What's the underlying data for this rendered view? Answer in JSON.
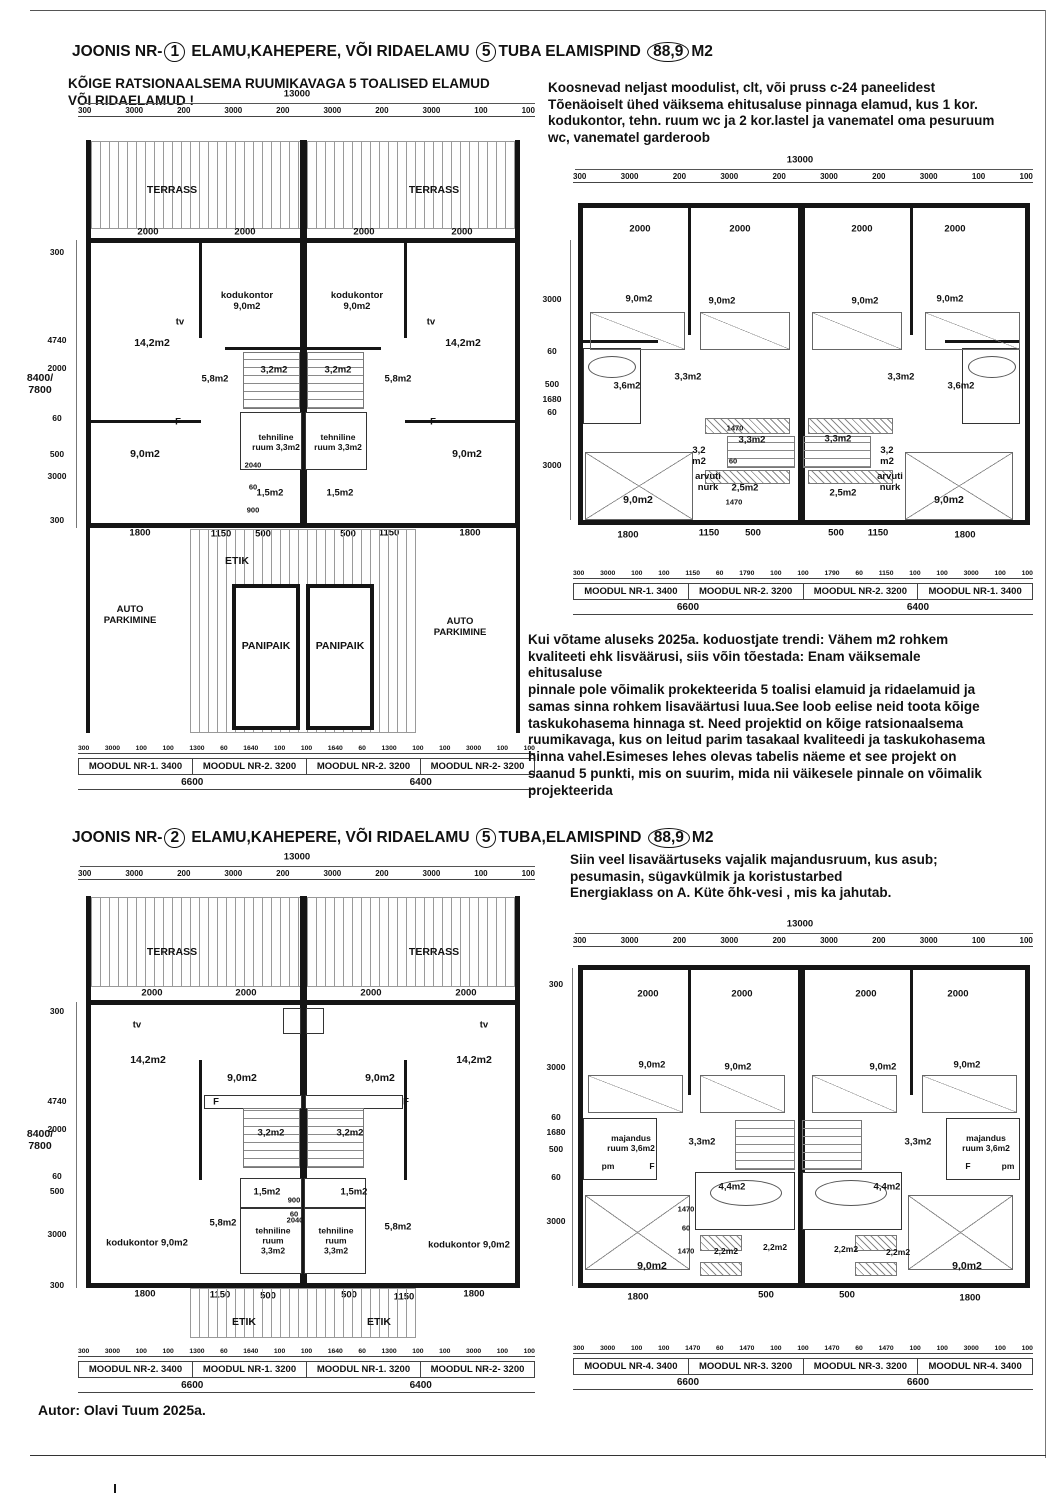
{
  "joonis1": {
    "title": {
      "pre": "JOONIS NR-",
      "n": "1",
      "mid": "ELAMU,KAHEPERE, VÕI RIDAELAMU",
      "rooms": "5",
      "mid2": "TUBA ELAMISPIND",
      "area": "88,9",
      "unit": "M2"
    },
    "subtitle": "KÕIGE RATSIONAALSEMA RUUMIKAVAGA  5 TOALISED ELAMUD\nVÕI RIDAELAMUD !",
    "desc": "Koosnevad neljast moodulist, clt, või pruss c-24 paneelidest\nTõenäoiselt ühed väiksema ehitusaluse pinnaga elamud, kus  1 kor.\nkodukontor, tehn. ruum  wc ja 2 kor.lastel ja vanematel oma pesuruum\nwc, vanematel garderoob"
  },
  "joonis2": {
    "title": {
      "pre": "JOONIS NR-",
      "n": "2",
      "mid": "ELAMU,KAHEPERE, VÕI RIDAELAMU",
      "rooms": "5",
      "mid2": "TUBA,ELAMISPIND",
      "area": "88,9",
      "unit": "M2"
    },
    "desc": "Siin veel lisaväärtuseks vajalik  majandusruum, kus asub;\npesumasin, sügavkülmik ja koristustarbed\nEnergiaklass on A. Küte õhk-vesi , mis ka jahutab."
  },
  "mid_text": "Kui võtame aluseks  2025a. koduostjate trendi: Vähem m2 rohkem\nkvaliteeti ehk lisväärusi, siis võin tõestada: Enam väiksemale\nehitusaluse\npinnale pole võimalik prokekteerida 5 toalisi elamuid ja ridaelamuid ja\nsamas sinna rohkem lisaväärtusi luua.See loob eelise neid toota kõige\ntaskukohasema hinnaga st. Need projektid on kõige ratsionaalsema\nruumikavaga, kus on leitud parim tasakaal kvaliteedi ja taskukohasema\nhinna vahel.Esimeses lehes olevas tabelis näeme et see projekt on\nsaanud  5 punkti, mis on suurim, mida nii väikesele pinnale on võimalik\nprojekteerida",
  "footer": "Autor:  Olavi  Tuum        2025a.",
  "plans": {
    "p1": {
      "total_top": "13000",
      "top_chain": [
        "300",
        "3000",
        "200",
        "3000",
        "200",
        "3000",
        "200",
        "3000",
        "100",
        "100"
      ],
      "win": "2000",
      "left_chain": [
        "300",
        "4740",
        "2000",
        "60",
        "500",
        "3000",
        "300"
      ],
      "left_total": "8400/\n7800",
      "rooms": {
        "terrass": "TERRASS",
        "kodukontor": "kodukontor\n9,0m2",
        "tv": "tv",
        "living": "14,2m2",
        "stair": "3,2m2",
        "r58": "5,8m2",
        "f": "F",
        "tehniline": "tehniline\nruum 3,3m2",
        "d2040": "2040",
        "kitchen": "9,0m2",
        "d60": "60",
        "wc": "1,5m2",
        "d900": "900",
        "etik": "ETIK",
        "auto": "AUTO\nPARKIMINE",
        "panipaik": "PANIPAIK"
      },
      "mid_dims": [
        "1800",
        "1150",
        "500",
        "500",
        "1150",
        "1800"
      ],
      "bot_chain": [
        "300",
        "3000",
        "100",
        "100",
        "1300",
        "60",
        "1640",
        "100",
        "100",
        "1640",
        "60",
        "1300",
        "100",
        "100",
        "3000",
        "100",
        "100"
      ],
      "modules": [
        "MOODUL NR-1. 3400",
        "MOODUL NR-2. 3200",
        "MOODUL NR-2. 3200",
        "MOODUL NR-2- 3200"
      ],
      "totals": [
        "6600",
        "6400"
      ]
    },
    "p2": {
      "total_top": "13000",
      "top_chain": [
        "300",
        "3000",
        "200",
        "3000",
        "200",
        "3000",
        "200",
        "3000",
        "100",
        "100"
      ],
      "win": "2000",
      "left_chain": [
        "3000",
        "60",
        "500",
        "1680",
        "60",
        "3000"
      ],
      "rooms": {
        "bed": "9,0m2",
        "bath36": "3,6m2",
        "hall33": "3,3m2",
        "mid33": "3,3m2",
        "d1470": "1470",
        "d60": "60",
        "r32": "3,2\nm2",
        "arvuti": "arvuti\nnurk",
        "r25": "2,5m2",
        "bed2": "9,0m2"
      },
      "mid_dims": [
        "1800",
        "1150",
        "500",
        "500",
        "1150",
        "1800"
      ],
      "bot_chain": [
        "300",
        "3000",
        "100",
        "100",
        "1150",
        "60",
        "1790",
        "100",
        "100",
        "1790",
        "60",
        "1150",
        "100",
        "100",
        "3000",
        "100",
        "100"
      ],
      "modules": [
        "MOODUL NR-1. 3400",
        "MOODUL NR-2. 3200",
        "MOODUL NR-2. 3200",
        "MOODUL NR-1. 3400"
      ],
      "totals": [
        "6600",
        "6400"
      ]
    },
    "p3": {
      "total_top": "13000",
      "top_chain": [
        "300",
        "3000",
        "200",
        "3000",
        "200",
        "3000",
        "200",
        "3000",
        "100",
        "100"
      ],
      "win": "2000",
      "left_chain": [
        "300",
        "4740",
        "2000",
        "60",
        "500",
        "3000",
        "300"
      ],
      "left_total": "8400/\n7800",
      "rooms": {
        "terrass": "TERRASS",
        "tv": "tv",
        "living": "14,2m2",
        "dining": "9,0m2",
        "f": "F",
        "stair": "3,2m2",
        "wc": "1,5m2",
        "d900": "900",
        "d60": "60",
        "r58": "5,8m2",
        "tehniline": "tehniline\nruum\n3,3m2",
        "d2040": "2040",
        "kodukontor": "kodukontor 9,0m2",
        "etik": "ETIK"
      },
      "mid_dims": [
        "1800",
        "1150",
        "500",
        "500",
        "1150",
        "1800"
      ],
      "bot_chain": [
        "300",
        "3000",
        "100",
        "100",
        "1300",
        "60",
        "1640",
        "100",
        "100",
        "1640",
        "60",
        "1300",
        "100",
        "100",
        "3000",
        "100",
        "100"
      ],
      "modules": [
        "MOODUL NR-2. 3400",
        "MOODUL NR-1. 3200",
        "MOODUL NR-1. 3200",
        "MOODUL NR-2- 3200"
      ],
      "totals": [
        "6600",
        "6400"
      ]
    },
    "p4": {
      "total_top": "13000",
      "top_chain": [
        "300",
        "3000",
        "200",
        "3000",
        "200",
        "3000",
        "200",
        "3000",
        "100",
        "100"
      ],
      "win": "2000",
      "left_chain": [
        "300",
        "3000",
        "60",
        "1680",
        "500",
        "60",
        "3000"
      ],
      "rooms": {
        "bed": "9,0m2",
        "majandus": "majandus\nruum 3,6m2",
        "pm": "pm",
        "f": "F",
        "hall33": "3,3m2",
        "bath44": "4,4m2",
        "d1470": "1470",
        "d60": "60",
        "r22": "2,2m2",
        "bed2": "9,0m2"
      },
      "mid_dims": [
        "1800",
        "500",
        "500",
        "1800"
      ],
      "bot_chain": [
        "300",
        "3000",
        "100",
        "100",
        "1470",
        "60",
        "1470",
        "100",
        "100",
        "1470",
        "60",
        "1470",
        "100",
        "100",
        "3000",
        "100",
        "100"
      ],
      "modules": [
        "MOODUL NR-4. 3400",
        "MOODUL NR-3. 3200",
        "MOODUL NR-3. 3200",
        "MOODUL NR-4. 3400"
      ],
      "totals": [
        "6600",
        "6600"
      ]
    }
  }
}
